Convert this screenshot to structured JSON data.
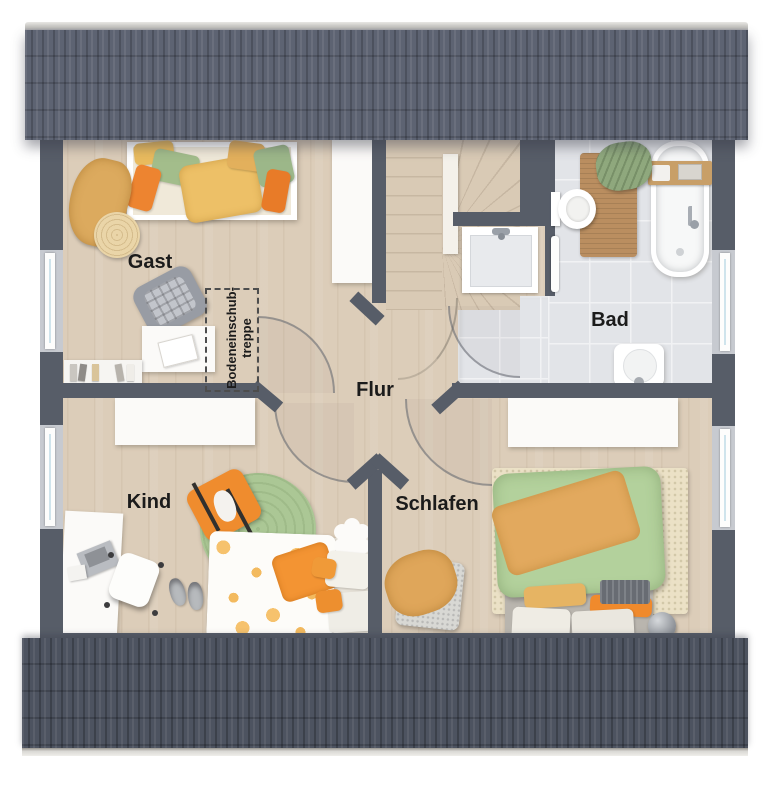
{
  "floorplan": {
    "type": "residential-upper-floor-plan",
    "rooms": [
      {
        "id": "gast",
        "label": "Gast"
      },
      {
        "id": "bad",
        "label": "Bad"
      },
      {
        "id": "flur",
        "label": "Flur"
      },
      {
        "id": "kind",
        "label": "Kind"
      },
      {
        "id": "schlafen",
        "label": "Schlafen"
      }
    ],
    "attic": {
      "line1": "Bodeneinschub-",
      "line2": "treppe"
    },
    "colors": {
      "roof_top": "#5d6372",
      "roof_bottom": "#4d5360",
      "wall": "#575d68",
      "floor_wood": "#dccdb9",
      "floor_tile": "#e2e4e8",
      "accent_orange": "#ef8c2e",
      "accent_green": "#abc795",
      "accent_green_light": "#b3d19c",
      "accent_mustard": "#e2a95e"
    }
  }
}
